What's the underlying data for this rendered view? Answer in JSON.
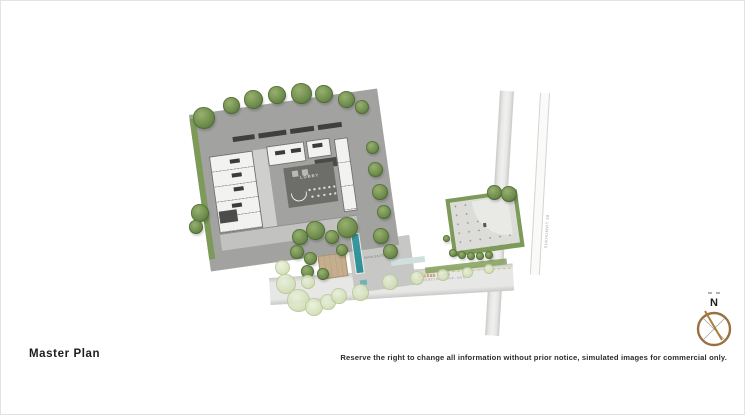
{
  "title": "Master Plan",
  "disclaimer": "Reserve the right to change all information without prior notice, simulated images for commercial only.",
  "compass": {
    "label": "N"
  },
  "plan": {
    "lobby_label": "LOBBY",
    "entrance_label": "MAIN ENTRANCE",
    "access_road": {
      "name": "ACCESS ROAD",
      "sub": "(FOR PROJECT ENTRANCE - EXIT)"
    },
    "side_road": {
      "name": "SUKHUMVIT 39"
    }
  },
  "colors": {
    "road": "#e7e7e5",
    "road_edge": "#c9c9c7",
    "dash": "#c3cc7d",
    "building": "#f2f2f0",
    "roof": "#3f3f3d",
    "lobby": "#6d6d69",
    "hedge": "#7d9a58",
    "tree_hi": "#97b06e",
    "tree_mid": "#6f8d4d",
    "tree_dark": "#4f6b37",
    "tree_l_hi": "#eaf0dc",
    "tree_l_mid": "#d4e0b8",
    "tree_l_dark": "#bdcc9b",
    "water": "#2f8f96",
    "deck": "#c4ae8e",
    "label_orange": "#b5763d",
    "label_gray": "#9c9c9a",
    "compass_ring": "#9a7040",
    "compass_needle": "#a87d3e",
    "text": "#1c1c1c"
  }
}
